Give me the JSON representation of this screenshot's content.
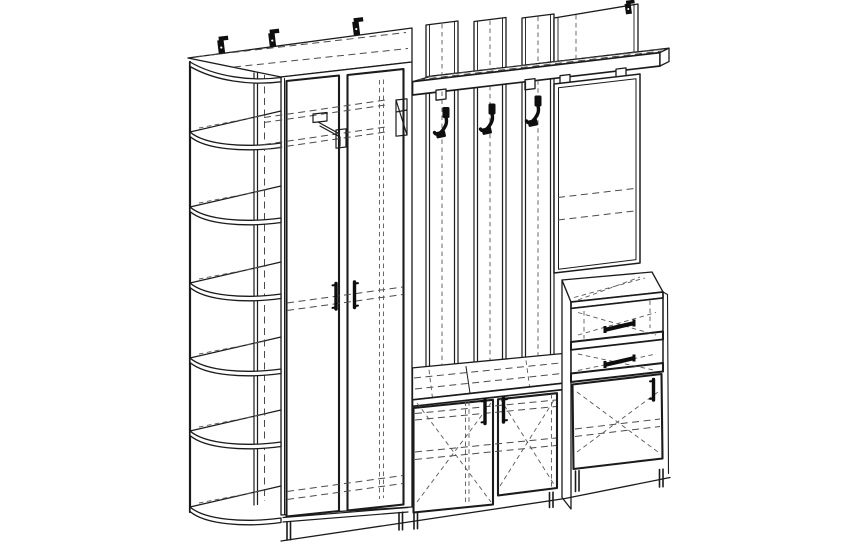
{
  "page": {
    "title": "Hallway furniture set - technical perspective line drawing",
    "drawing_type": "wireframe furniture diagram, black lines on white, hidden details dashed"
  },
  "style": {
    "paper_color": "#ffffff",
    "line_color": "#1b1b1b",
    "hidden_line_color": "#4b4b4b",
    "hardware_color": "#0e0e0e"
  },
  "furniture_set": {
    "corner_shelf_unit": {
      "label": "corner shelf unit",
      "open_shelves": 6,
      "shelf_shape": "quarter-round curved fronts"
    },
    "wardrobe": {
      "label": "two-door wardrobe",
      "doors": 2,
      "handles": 2,
      "hidden_details": [
        "top shelf",
        "pull-down hanger rod",
        "middle shelf",
        "bottom shelf"
      ]
    },
    "coat_rack": {
      "label": "coat rack wall panel",
      "slats": 3,
      "hooks": 3,
      "hat_shelf": true,
      "shelf_brackets": 4,
      "mirror_back_panel": 1
    },
    "mirror": {
      "label": "wall mirror",
      "frame": "double-line frame",
      "hidden_lines": 2
    },
    "drawer_cabinet": {
      "label": "drawer cabinet",
      "drawers": 2,
      "handles": 2
    },
    "base_cabinet": {
      "label": "right base cabinet",
      "doors": 1,
      "handles": 1,
      "hidden_shelf": true
    },
    "bench_cabinet": {
      "label": "shoe bench cabinet",
      "doors": 2,
      "handles": 2,
      "hidden_shelves": 2
    },
    "wall_mount_brackets": 4,
    "visible_legs": 6
  }
}
